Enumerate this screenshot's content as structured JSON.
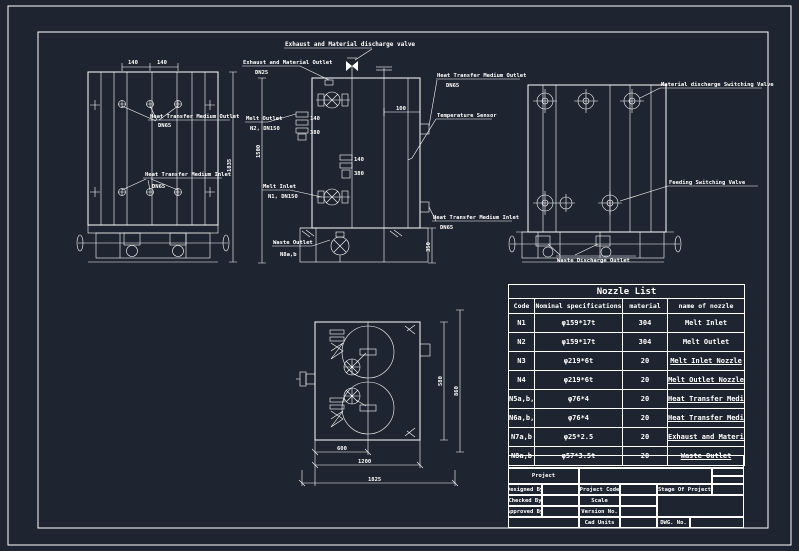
{
  "colors": {
    "background": "#1f2530",
    "line": "#ffffff"
  },
  "views": {
    "front": {
      "outlet_label": "Heat Transfer Medium Outlet",
      "outlet_dn": "DN65",
      "inlet_label": "Heat Transfer Medium Inlet",
      "inlet_dn": "DN65",
      "dim_height": "1835",
      "dim_top_a": "140",
      "dim_top_b": "140"
    },
    "elevation": {
      "discharge_valve_label": "Exhaust and Material discharge valve",
      "exhaust_outlet_label": "Exhaust and Material Outlet",
      "exhaust_outlet_dn": "DN25",
      "melt_outlet_label": "Melt Outlet",
      "melt_outlet_dn": "N2, DN150",
      "melt_inlet_label": "Melt Inlet",
      "melt_inlet_dn": "N1, DN150",
      "htm_outlet_label": "Heat Transfer Medium Outlet",
      "htm_outlet_dn": "DN65",
      "temp_sensor_label": "Temperature Sensor",
      "htm_inlet_label": "Heat Transfer Medium Inlet",
      "htm_inlet_dn": "DN65",
      "waste_outlet_label": "Waste Outlet",
      "waste_outlet_dn": "N8a,b",
      "dim_left": "1500",
      "dim_100": "100",
      "dim_140": "140",
      "dim_380": "380",
      "dim_base": "350"
    },
    "side": {
      "material_valve_label": "Material discharge Switching Valve",
      "feeding_valve_label": "Feeding Switching Valve",
      "drain_label": "Waste Discharge Outlet"
    },
    "plan": {
      "dim_600": "600",
      "dim_1200": "1200",
      "dim_1825": "1825",
      "dim_580": "580",
      "dim_860": "860"
    }
  },
  "nozzle_table": {
    "title": "Nozzle List",
    "headers": [
      "Code",
      "Nominal specifications",
      "material",
      "name of nozzle"
    ],
    "rows": [
      [
        "N1",
        "φ159*17t",
        "304",
        "Melt Inlet"
      ],
      [
        "N2",
        "φ159*17t",
        "304",
        "Melt Outlet"
      ],
      [
        "N3",
        "φ219*6t",
        "20",
        "Melt Inlet Nozzle"
      ],
      [
        "N4",
        "φ219*6t",
        "20",
        "Melt Outlet Nozzle"
      ],
      [
        "N5a,b,c",
        "φ76*4",
        "20",
        "Heat Transfer Medium Inlet"
      ],
      [
        "N6a,b,c",
        "φ76*4",
        "20",
        "Heat Transfer Medium Outlet"
      ],
      [
        "N7a,b",
        "φ25*2.5",
        "20",
        "Exhaust and Material Outlet"
      ],
      [
        "N8a,b",
        "φ57*3.5t",
        "20",
        "Waste Outlet"
      ]
    ]
  },
  "title_block": {
    "project_label": "Project",
    "designed_by": "Designed By",
    "checked_by": "Checked By",
    "approved_by": "Approved By",
    "project_code": "Project Code",
    "scale": "Scale",
    "version_no": "Version No.",
    "cad_units": "Cad Units",
    "stage_of_project": "Stage Of Project",
    "dwg_no": "DWG. No."
  }
}
